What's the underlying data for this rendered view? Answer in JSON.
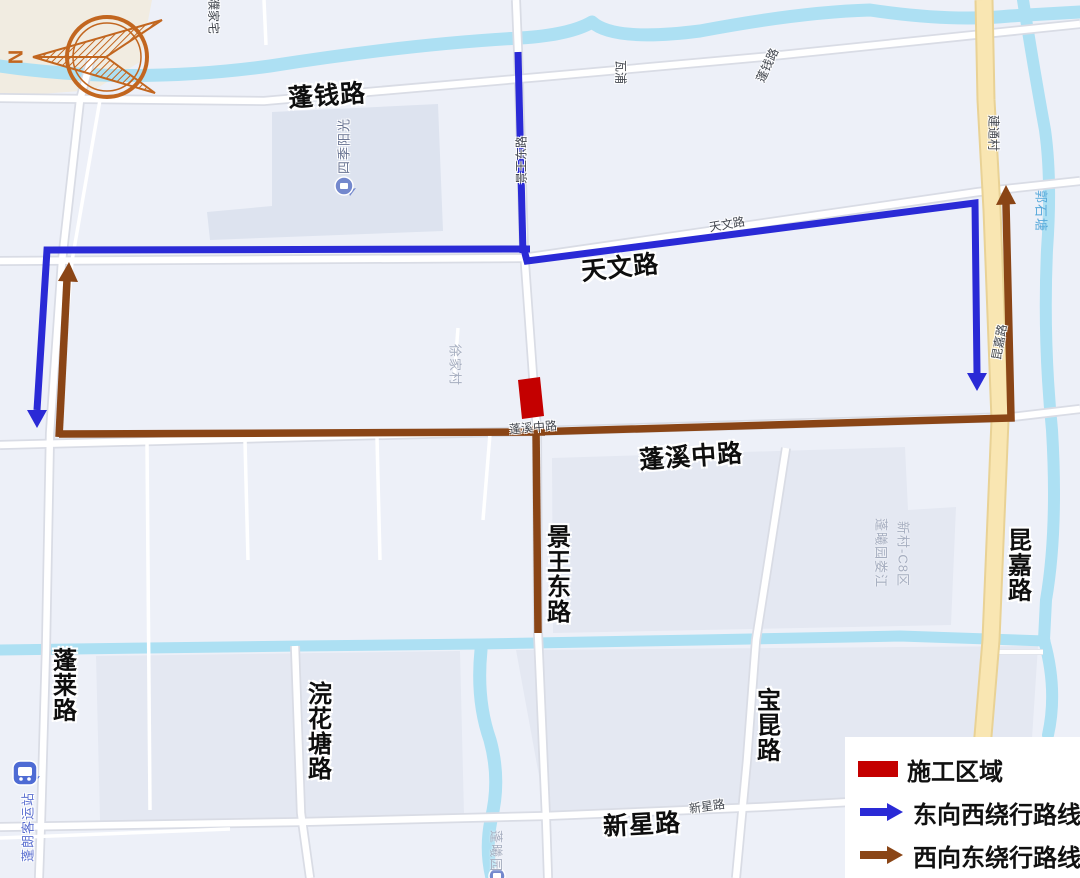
{
  "colors": {
    "bg": "#edf0f8",
    "block": "#dde3ef",
    "block2": "#e4e8f2",
    "beige": "#f1ece1",
    "river": "#ade0f3",
    "roadFill": "#ffffff",
    "roadCasing": "#d9dce5",
    "yellowFill": "#f9e6b2",
    "yellowCasing": "#e9d295",
    "routeBlue": "#2a2ad6",
    "routeBrown": "#8a4516",
    "construction": "#c40000",
    "compass": "#c2661f"
  },
  "legend": {
    "items": [
      {
        "label": "施工区域"
      },
      {
        "label": "东向西绕行路线"
      },
      {
        "label": "西向东绕行路线"
      }
    ]
  },
  "compass": {
    "letter": "N"
  },
  "map": {
    "labels": [
      {
        "id": "pengqian-road",
        "text": "蓬钱路",
        "cls": "lbl-bold",
        "x": 327,
        "y": 94,
        "rot": -4
      },
      {
        "id": "tianwen-road",
        "text": "天文路",
        "cls": "lbl-bold",
        "x": 620,
        "y": 266,
        "rot": -6
      },
      {
        "id": "pengxi-middle-road",
        "text": "蓬溪中路",
        "cls": "lbl-bold",
        "x": 691,
        "y": 455,
        "rot": -4
      },
      {
        "id": "xinxing-road",
        "text": "新星路",
        "cls": "lbl-bold",
        "x": 642,
        "y": 823,
        "rot": -3
      },
      {
        "id": "jingwang-east-road",
        "text": "景王东路",
        "cls": "lbl-bold-v",
        "x": 556,
        "y": 574
      },
      {
        "id": "penglai-road",
        "text": "蓬莱路",
        "cls": "lbl-bold-v",
        "x": 62,
        "y": 685
      },
      {
        "id": "huanhuatang-road",
        "text": "浣花塘路",
        "cls": "lbl-bold-v",
        "x": 317,
        "y": 731
      },
      {
        "id": "baokun-road",
        "text": "宝昆路",
        "cls": "lbl-bold-v",
        "x": 766,
        "y": 725
      },
      {
        "id": "kunjia-road",
        "text": "昆嘉路",
        "cls": "lbl-bold-v",
        "x": 1017,
        "y": 565
      },
      {
        "id": "jingwang-east-road-small",
        "text": "景王东路",
        "cls": "lbl-small",
        "x": 521,
        "y": 160,
        "rot": -90
      },
      {
        "id": "wapu",
        "text": "瓦浦",
        "cls": "lbl-small",
        "x": 621,
        "y": 72,
        "rot": 90
      },
      {
        "id": "pengqian-road-small",
        "text": "蓬钱路",
        "cls": "lbl-small",
        "x": 767,
        "y": 65,
        "rot": -65
      },
      {
        "id": "tianwen-road-small",
        "text": "天文路",
        "cls": "lbl-small",
        "x": 727,
        "y": 224,
        "rot": -10
      },
      {
        "id": "jiantong-village",
        "text": "建通村",
        "cls": "lbl-small",
        "x": 994,
        "y": 133,
        "rot": 90
      },
      {
        "id": "kunjia-road-small",
        "text": "昆嘉路",
        "cls": "lbl-small",
        "x": 999,
        "y": 342,
        "rot": -80
      },
      {
        "id": "pengxi-middle-road-small",
        "text": "蓬溪中路",
        "cls": "lbl-small",
        "x": 533,
        "y": 427,
        "rot": -5
      },
      {
        "id": "xinxing-road-small",
        "text": "新星路",
        "cls": "lbl-small",
        "x": 707,
        "y": 806,
        "rot": -8
      },
      {
        "id": "pujiazhai",
        "text": "濮家宅",
        "cls": "lbl-small",
        "x": 214,
        "y": 16,
        "rot": 90
      },
      {
        "id": "xujia-village",
        "text": "徐家村",
        "cls": "lbl-area",
        "x": 456,
        "y": 365,
        "rot": 90
      },
      {
        "id": "pengxiyuan-loujiang",
        "text": "蓬曦园娄江",
        "cls": "lbl-area",
        "x": 882,
        "y": 553,
        "rot": 90
      },
      {
        "id": "xincun-c8",
        "text": "新村-C8区",
        "cls": "lbl-area",
        "x": 904,
        "y": 554,
        "rot": 90
      },
      {
        "id": "pengxiyuan",
        "text": "蓬曦园",
        "cls": "lbl-area",
        "x": 497,
        "y": 851,
        "rot": 90
      },
      {
        "id": "guoshitang",
        "text": "郭石塘",
        "cls": "lbl-water",
        "x": 1042,
        "y": 211,
        "rot": 90
      },
      {
        "id": "sijiyangguang",
        "text": "四季阳光",
        "cls": "lbl-poi",
        "x": 343,
        "y": 146,
        "rot": -90
      },
      {
        "id": "penglang-bus-station",
        "text": "蓬朗客运站",
        "cls": "lbl-poi-blue",
        "x": 27,
        "y": 827,
        "rot": -90
      },
      {
        "id": "compass-n",
        "text": "N",
        "cls": "compass-n",
        "x": 17,
        "y": 57,
        "rot": -90
      }
    ]
  }
}
